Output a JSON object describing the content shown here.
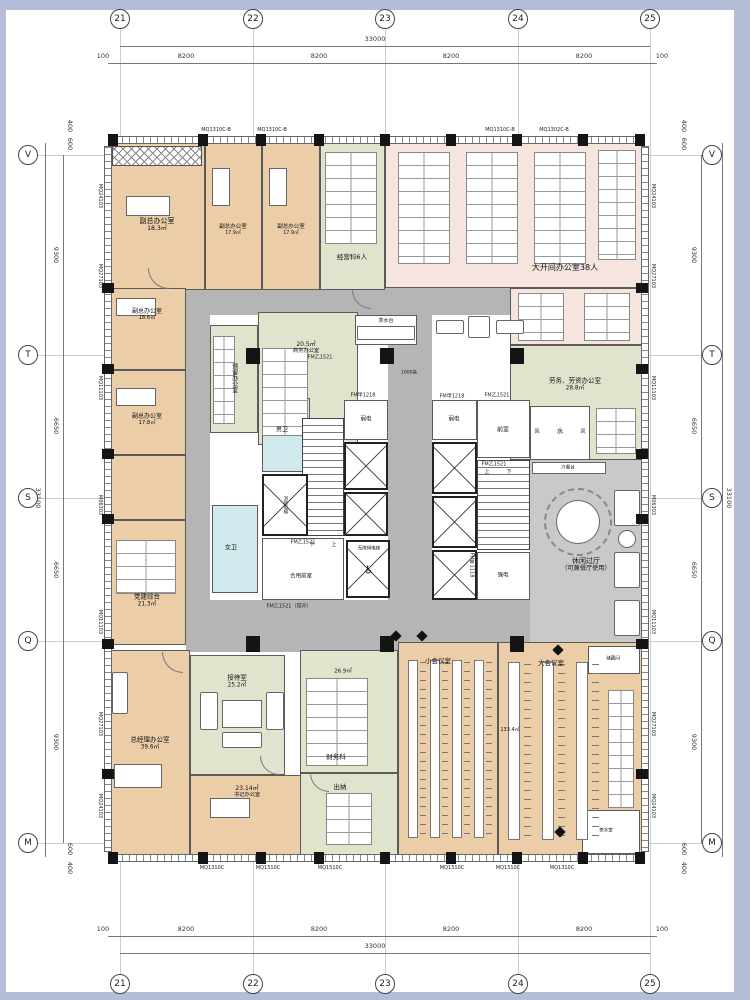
{
  "grid": {
    "cols": [
      "21",
      "22",
      "23",
      "24",
      "25"
    ],
    "rows": [
      "V",
      "T",
      "S",
      "Q",
      "M"
    ]
  },
  "dims": {
    "total_h": "33000",
    "seg_h": "8200",
    "edge_h": "100",
    "total_v": "33100",
    "seg_v_a": "9300",
    "seg_v_b": "6650",
    "edge_v_a": "400",
    "edge_v_b": "600"
  },
  "walls": {
    "left": [
      "MQ24103",
      "MQ27103",
      "MQ11103",
      "M06303",
      "MQ11103",
      "MQ27103",
      "MQ24103"
    ],
    "right": [
      "MQ24103",
      "MQ27103",
      "MQ11103",
      "M06303",
      "MQ11103",
      "MQ27103",
      "MQ24103"
    ],
    "top_label": "MQ1310C-B",
    "top_label2": "MQ1302C-B",
    "bottom_label_a": "MQ1310C",
    "bottom_label_b": "MQ1510C"
  },
  "rooms": {
    "vp1": {
      "name": "副总办公室",
      "area": "18.3㎡"
    },
    "vp2": {
      "name": "副总办公室",
      "area": "17.9㎡"
    },
    "vp3": {
      "name": "副总办公室",
      "area": "17.9㎡"
    },
    "ops": {
      "name": "经营科6人"
    },
    "open": {
      "name": "大开间办公室38人"
    },
    "labor": {
      "name": "劳务、劳资办公室",
      "area": "28.8㎡"
    },
    "vp4": {
      "name": "副总办公室",
      "area": "18.6㎡"
    },
    "vp5": {
      "name": "副总办公室",
      "area": "17.8㎡"
    },
    "reserved": {
      "name": "预留办公室"
    },
    "biz": {
      "name": "商务办公室",
      "area": "20.5㎡"
    },
    "party": {
      "name": "党建综合",
      "area": "21.3㎡"
    },
    "leisure": {
      "name": "休闲过厅",
      "sub": "（可兼餐厅使用）"
    },
    "gm": {
      "name": "总经理办公室",
      "area": "39.6㎡"
    },
    "reception": {
      "name": "接待室",
      "area": "25.2㎡"
    },
    "secretary": {
      "name": "书记办公室",
      "area": "23.14㎡"
    },
    "finance": {
      "name": "财务科",
      "area": "26.9㎡"
    },
    "cashier": {
      "name": "出纳"
    },
    "meet_s": {
      "name": "小会议室"
    },
    "meet_l": {
      "name": "大会议室",
      "area": "133.4㎡"
    },
    "storage": {
      "name": "储藏间"
    },
    "tea": {
      "name": "茶水室"
    },
    "wc_m": {
      "name": "男卫"
    },
    "wc_f": {
      "name": "女卫"
    },
    "water": {
      "name": "水"
    },
    "ante": {
      "name": "前室"
    },
    "ante_shared": {
      "name": "合用前室"
    },
    "weak": {
      "name": "弱电"
    },
    "strong": {
      "name": "强电"
    },
    "fire_lift": {
      "name": "消防电梯"
    },
    "acc_lift": {
      "name": "无障碍电梯"
    }
  },
  "doors": {
    "fm_b1521": "FM乙1521",
    "fm_a1218": "FM甲1218",
    "fm_a1118": "FM甲1118",
    "fm_b1521_open": "FM乙1521（常开）"
  },
  "notes": {
    "tea_counter": "茶水台",
    "counter_h": "1000高",
    "cold_buffet": "冷餐台",
    "shaft": "风",
    "up": "上",
    "down": "下",
    "wheelchair": "♿"
  }
}
